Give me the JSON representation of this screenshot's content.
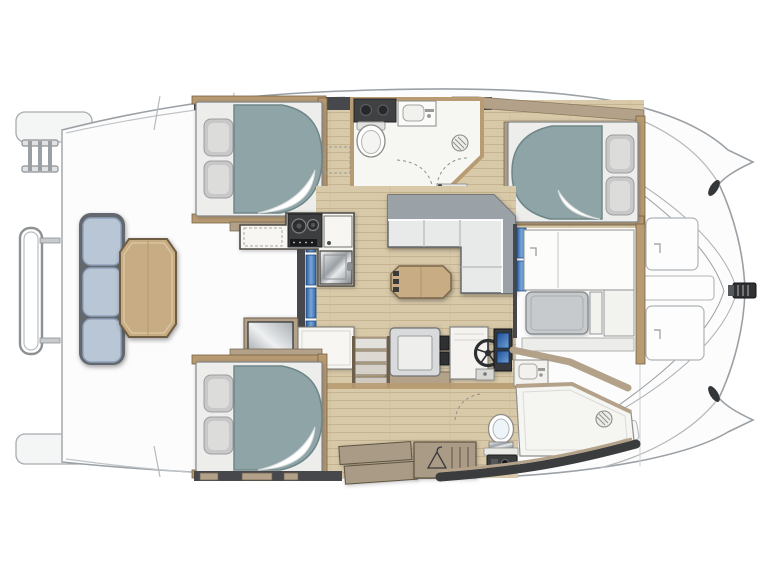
{
  "title": "catamaran-deck-floorplan",
  "orientation": {
    "bow": "right",
    "stern": "left",
    "port_hull": "top",
    "starboard_hull": "bottom"
  },
  "palette": {
    "deck-white": "#fcfcfc",
    "hull-line": "#9aa0a5",
    "sheer-line": "#c0c4c8",
    "wood-floor": "#d8c9a8",
    "plank-line": "#c5b391",
    "wood-trim": "#b89b72",
    "wood-trim-dark": "#77633f",
    "taupe": "#b3a289",
    "taupe-dark": "#6d5f4b",
    "wall-dark": "#46484b",
    "mattress": "#8ea4a6",
    "mattress-edge": "#6e8687",
    "pillow": "#c7c8c7",
    "bed-base": "#ededeb",
    "cushion-blue": "#b9c6d6",
    "cushion-blue-edge": "#8fa2bb",
    "table-wood": "#c8ad84",
    "sofa-cushion": "#e8e9e9",
    "sofa-back": "#9aa2a8",
    "counter-white": "#f7f6f2",
    "appliance-dark": "#3c3e40",
    "glass-blue": "#2f66a8",
    "fixture-line": "#8b8b88"
  },
  "rooms": [
    {
      "name": "aft-cockpit",
      "features": [
        "bench-seat-3-cushions",
        "wood-table",
        "swim-ladder",
        "stern-rail"
      ]
    },
    {
      "name": "salon",
      "features": [
        "l-shaped-sofa",
        "folding-wood-table",
        "nav-station-with-wheel",
        "sliding-glass-door"
      ]
    },
    {
      "name": "galley",
      "features": [
        "two-burner-stove",
        "stainless-sink",
        "fridge",
        "counters"
      ]
    },
    {
      "name": "port-aft-cabin",
      "features": [
        "double-berth",
        "two-pillows"
      ]
    },
    {
      "name": "port-head",
      "features": [
        "toilet",
        "washbasin",
        "vanity-counter",
        "shower-drain"
      ]
    },
    {
      "name": "port-forward-cabin",
      "features": [
        "double-berth",
        "two-pillows"
      ]
    },
    {
      "name": "starboard-aft-cabin",
      "features": [
        "double-berth",
        "two-pillows",
        "wardrobe-with-hanger"
      ]
    },
    {
      "name": "starboard-head",
      "features": [
        "toilet",
        "washbasin",
        "walk-in-shower-with-drain"
      ]
    },
    {
      "name": "forward-lounge",
      "features": [
        "bench",
        "storage-panels"
      ]
    },
    {
      "name": "foredeck",
      "features": [
        "deck-hatches",
        "anchor-roller",
        "bow-cleats",
        "rigging-lines"
      ]
    }
  ],
  "fixture_icons": [
    "toilet-icon",
    "washbasin-icon",
    "shower-drain-icon",
    "stove-burners-icon",
    "sink-icon",
    "helm-wheel-icon",
    "hanger-icon",
    "door-swing-arc",
    "stair-steps",
    "anchor-roller-icon"
  ]
}
